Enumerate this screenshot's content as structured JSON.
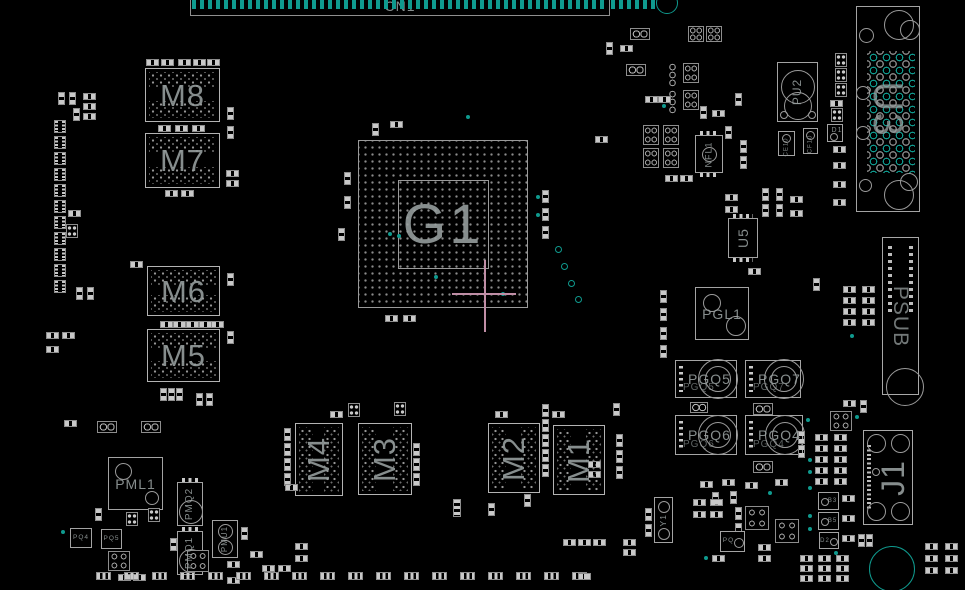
{
  "app": {
    "view_name": "pcb-boardview"
  },
  "colors": {
    "background": "#000000",
    "component_outline": "#a0a0a0",
    "pad_fill": "#c9c9c9",
    "highlight_teal": "#0f9a8e",
    "label_gray": "#98a0a0",
    "crosshair_pink": "#c08ea6"
  },
  "refdes": {
    "cn1": "CN1",
    "g1": "G1",
    "m1": "M1",
    "m2": "M2",
    "m3": "M3",
    "m4": "M4",
    "m5": "M5",
    "m6": "M6",
    "m7": "M7",
    "m8": "M8",
    "u3": "U3",
    "u5": "U5",
    "pu2": "PU2",
    "nfl1": "NFL1",
    "d1": "D1",
    "pgl1": "PGL1",
    "pgq5": "PGQ5",
    "pgq7": "PGQ7",
    "pgq6": "PGQ6",
    "pgq4": "PGQ4",
    "psub": "PSUB",
    "j1": "J1",
    "y1": "Y1",
    "pml1": "PML1",
    "pmq2": "PMQ2",
    "pmq1": "PMQ1",
    "pmu1": "PMU1",
    "pq4": "PQ4",
    "pq5": "PQ5",
    "pq": "PQ",
    "b3": "B3",
    "b5": "B5",
    "d2": "D2",
    "ce10": "CE10",
    "cf10": "CF10"
  }
}
